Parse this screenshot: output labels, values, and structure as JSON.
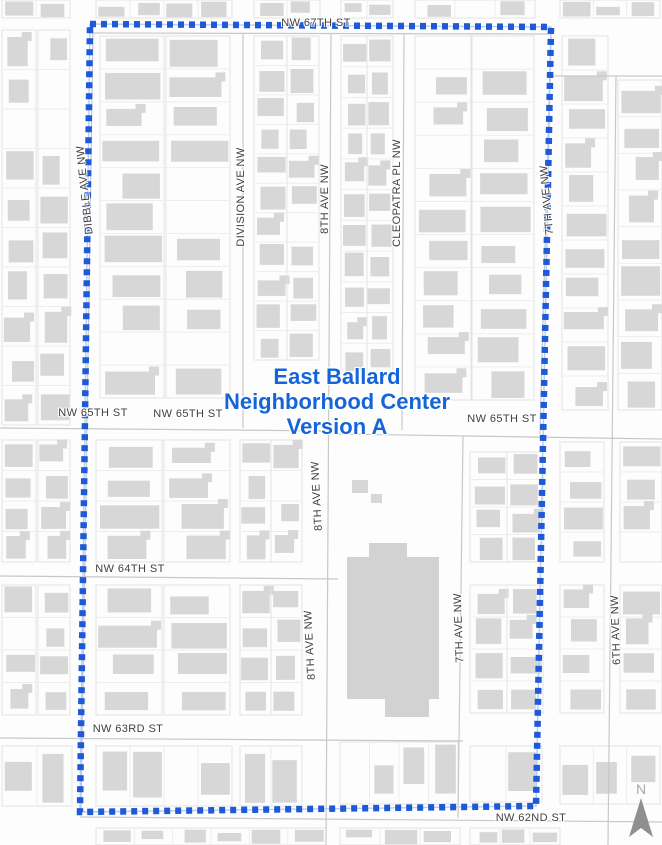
{
  "map": {
    "background": "#fdfdfd",
    "colors": {
      "building": "#d7d7d7",
      "building_large": "#d2d2d2",
      "parcel_outline": "#e3e3e3",
      "parcel_divider": "#ededed",
      "street_line": "#c8c8c8",
      "label_text": "#3f3f3f",
      "boundary_dash": "#1e5ad8",
      "boundary_halo": "#b9cdf0",
      "title_blue": "#1565d8",
      "north_arrow": "#8f8f8f",
      "north_label": "#a9a9a9"
    },
    "title": {
      "lines": [
        "East Ballard",
        "Neighborhood Center",
        "Version A"
      ]
    },
    "north": {
      "label": "N"
    },
    "boundary": {
      "points": "90,24 551,27 536,806 80,812",
      "dash": "6 5",
      "width": 6.5
    },
    "labels": {
      "horizontal": [
        {
          "text": "NW 67TH ST",
          "x": 316,
          "y": 23
        },
        {
          "text": "NW 65TH ST",
          "x": 93,
          "y": 413
        },
        {
          "text": "NW 65TH ST",
          "x": 188,
          "y": 414
        },
        {
          "text": "NW 65TH ST",
          "x": 502,
          "y": 419
        },
        {
          "text": "NW 64TH ST",
          "x": 130,
          "y": 569
        },
        {
          "text": "NW 63RD ST",
          "x": 128,
          "y": 729
        },
        {
          "text": "NW 62ND ST",
          "x": 531,
          "y": 818
        }
      ],
      "vertical": [
        {
          "text": "DIBBLE AVE NW",
          "x": 85,
          "y": 190,
          "angle": -96
        },
        {
          "text": "DIVISION AVE NW",
          "x": 241,
          "y": 197,
          "angle": -90
        },
        {
          "text": "8TH AVE NW",
          "x": 325,
          "y": 199,
          "angle": -90
        },
        {
          "text": "CLEOPATRA PL NW",
          "x": 397,
          "y": 193,
          "angle": -90
        },
        {
          "text": "7TH AVE NW",
          "x": 547,
          "y": 200,
          "angle": -95
        },
        {
          "text": "8TH AVE NW",
          "x": 317,
          "y": 496,
          "angle": -93
        },
        {
          "text": "8TH AVE NW",
          "x": 310,
          "y": 645,
          "angle": -93
        },
        {
          "text": "7TH AVE NW",
          "x": 459,
          "y": 628,
          "angle": -92
        },
        {
          "text": "6TH AVE NW",
          "x": 616,
          "y": 630,
          "angle": -92
        }
      ]
    },
    "streets": [
      [
        92,
        33,
        549,
        34
      ],
      [
        552,
        76,
        662,
        76
      ],
      [
        0,
        428,
        336,
        431
      ],
      [
        336,
        434,
        662,
        439
      ],
      [
        0,
        576,
        338,
        579
      ],
      [
        0,
        738,
        463,
        741
      ],
      [
        80,
        817,
        662,
        822
      ],
      [
        93,
        30,
        81,
        810
      ],
      [
        243,
        34,
        243,
        428
      ],
      [
        331,
        34,
        326,
        845
      ],
      [
        404,
        34,
        402,
        430
      ],
      [
        551,
        28,
        540,
        434
      ],
      [
        463,
        436,
        458,
        818
      ],
      [
        616,
        76,
        608,
        845
      ]
    ],
    "blocks": [
      {
        "x": 2,
        "y": 30,
        "w": 34,
        "h": 395,
        "n": 10
      },
      {
        "x": 38,
        "y": 30,
        "w": 32,
        "h": 395,
        "n": 10
      },
      {
        "x": 100,
        "y": 36,
        "w": 64,
        "h": 362,
        "n": 11
      },
      {
        "x": 166,
        "y": 36,
        "w": 64,
        "h": 362,
        "n": 11
      },
      {
        "x": 254,
        "y": 36,
        "w": 33,
        "h": 324,
        "n": 11
      },
      {
        "x": 287,
        "y": 36,
        "w": 32,
        "h": 324,
        "n": 11
      },
      {
        "x": 341,
        "y": 36,
        "w": 26,
        "h": 338,
        "n": 11
      },
      {
        "x": 367,
        "y": 36,
        "w": 26,
        "h": 338,
        "n": 11
      },
      {
        "x": 415,
        "y": 36,
        "w": 56,
        "h": 364,
        "n": 11
      },
      {
        "x": 472,
        "y": 36,
        "w": 62,
        "h": 364,
        "n": 11
      },
      {
        "x": 562,
        "y": 36,
        "w": 46,
        "h": 374,
        "n": 11
      },
      {
        "x": 618,
        "y": 80,
        "w": 44,
        "h": 330,
        "n": 9
      },
      {
        "x": 2,
        "y": 440,
        "w": 34,
        "h": 122,
        "n": 4
      },
      {
        "x": 38,
        "y": 440,
        "w": 32,
        "h": 122,
        "n": 4
      },
      {
        "x": 96,
        "y": 440,
        "w": 66,
        "h": 122,
        "n": 4
      },
      {
        "x": 164,
        "y": 440,
        "w": 66,
        "h": 122,
        "n": 4
      },
      {
        "x": 240,
        "y": 440,
        "w": 31,
        "h": 122,
        "n": 4
      },
      {
        "x": 271,
        "y": 440,
        "w": 31,
        "h": 122,
        "n": 4
      },
      {
        "x": 470,
        "y": 452,
        "w": 37,
        "h": 110,
        "n": 4
      },
      {
        "x": 507,
        "y": 452,
        "w": 36,
        "h": 110,
        "n": 4
      },
      {
        "x": 560,
        "y": 442,
        "w": 44,
        "h": 120,
        "n": 4
      },
      {
        "x": 620,
        "y": 442,
        "w": 42,
        "h": 120,
        "n": 4
      },
      {
        "x": 2,
        "y": 585,
        "w": 34,
        "h": 130,
        "n": 4
      },
      {
        "x": 38,
        "y": 585,
        "w": 32,
        "h": 130,
        "n": 4
      },
      {
        "x": 96,
        "y": 585,
        "w": 66,
        "h": 130,
        "n": 4
      },
      {
        "x": 164,
        "y": 585,
        "w": 66,
        "h": 130,
        "n": 4
      },
      {
        "x": 240,
        "y": 585,
        "w": 31,
        "h": 130,
        "n": 4
      },
      {
        "x": 271,
        "y": 585,
        "w": 31,
        "h": 130,
        "n": 4
      },
      {
        "x": 470,
        "y": 585,
        "w": 37,
        "h": 128,
        "n": 4
      },
      {
        "x": 507,
        "y": 585,
        "w": 36,
        "h": 128,
        "n": 4
      },
      {
        "x": 560,
        "y": 585,
        "w": 44,
        "h": 128,
        "n": 4
      },
      {
        "x": 620,
        "y": 585,
        "w": 42,
        "h": 128,
        "n": 4
      },
      {
        "x": 2,
        "y": 746,
        "w": 70,
        "h": 60,
        "n": 2,
        "dir": "h"
      },
      {
        "x": 96,
        "y": 746,
        "w": 136,
        "h": 60,
        "n": 4,
        "dir": "h"
      },
      {
        "x": 240,
        "y": 746,
        "w": 62,
        "h": 60,
        "n": 2,
        "dir": "h"
      },
      {
        "x": 340,
        "y": 742,
        "w": 118,
        "h": 62,
        "n": 4,
        "dir": "h"
      },
      {
        "x": 470,
        "y": 746,
        "w": 72,
        "h": 56,
        "n": 2,
        "dir": "h"
      },
      {
        "x": 560,
        "y": 746,
        "w": 100,
        "h": 58,
        "n": 3,
        "dir": "h"
      },
      {
        "x": 96,
        "y": 828,
        "w": 230,
        "h": 17,
        "n": 6,
        "dir": "h"
      },
      {
        "x": 340,
        "y": 828,
        "w": 120,
        "h": 17,
        "n": 3,
        "dir": "h"
      },
      {
        "x": 470,
        "y": 828,
        "w": 90,
        "h": 17,
        "n": 3,
        "dir": "h"
      },
      {
        "x": 2,
        "y": 0,
        "w": 68,
        "h": 18,
        "n": 2,
        "dir": "h"
      },
      {
        "x": 96,
        "y": 0,
        "w": 136,
        "h": 18,
        "n": 4,
        "dir": "h"
      },
      {
        "x": 254,
        "y": 0,
        "w": 66,
        "h": 18,
        "n": 2,
        "dir": "h"
      },
      {
        "x": 341,
        "y": 0,
        "w": 52,
        "h": 18,
        "n": 2,
        "dir": "h"
      },
      {
        "x": 415,
        "y": 0,
        "w": 120,
        "h": 18,
        "n": 3,
        "dir": "h"
      },
      {
        "x": 560,
        "y": 0,
        "w": 100,
        "h": 18,
        "n": 3,
        "dir": "h"
      }
    ],
    "buildings": [
      {
        "x": 347,
        "y": 557,
        "w": 92,
        "h": 142,
        "large": true
      },
      {
        "x": 369,
        "y": 543,
        "w": 38,
        "h": 14,
        "large": true
      },
      {
        "x": 385,
        "y": 699,
        "w": 44,
        "h": 18,
        "large": true
      },
      {
        "x": 352,
        "y": 480,
        "w": 16,
        "h": 13
      },
      {
        "x": 371,
        "y": 494,
        "w": 11,
        "h": 9
      }
    ]
  }
}
